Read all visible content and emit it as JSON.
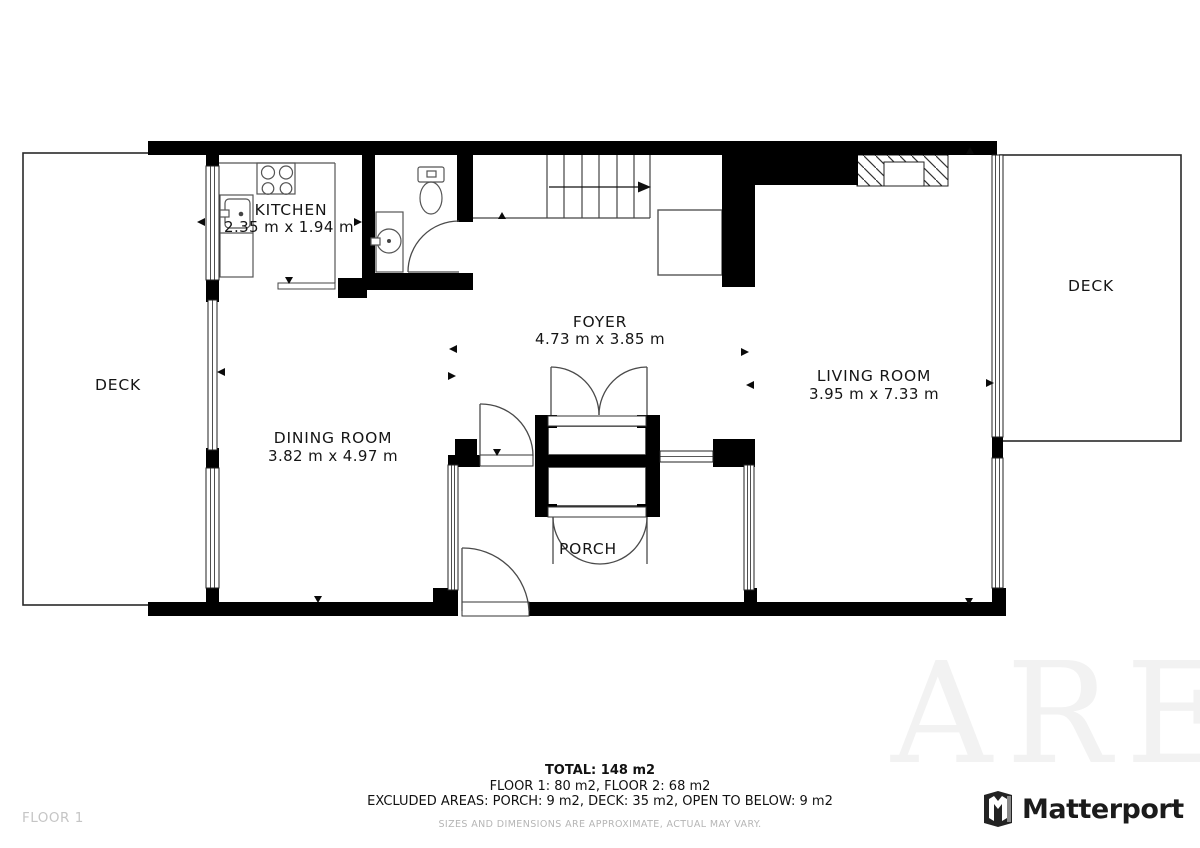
{
  "plan": {
    "floor_label": "FLOOR 1",
    "rooms": {
      "kitchen": {
        "name": "KITCHEN",
        "dims": "2.35 m x 1.94 m"
      },
      "foyer": {
        "name": "FOYER",
        "dims": "4.73 m x 3.85 m"
      },
      "dining_room": {
        "name": "DINING ROOM",
        "dims": "3.82 m x 4.97 m"
      },
      "living_room": {
        "name": "LIVING ROOM",
        "dims": "3.95 m x 7.33 m"
      },
      "porch": {
        "name": "PORCH"
      },
      "deck_left": {
        "name": "DECK"
      },
      "deck_right": {
        "name": "DECK"
      }
    }
  },
  "summary": {
    "total": "TOTAL: 148 m2",
    "floors": "FLOOR 1: 80 m2, FLOOR 2: 68 m2",
    "excluded": "EXCLUDED AREAS: PORCH: 9 m2, DECK: 35 m2, OPEN TO BELOW: 9 m2",
    "disclaimer": "SIZES AND DIMENSIONS ARE APPROXIMATE, ACTUAL MAY VARY."
  },
  "branding": {
    "name": "Matterport",
    "icon": "matterport-m-icon"
  },
  "watermark": {
    "text": "ARE"
  },
  "colors": {
    "wall": "#000000",
    "line": "#3a3a3a",
    "label": "#151515",
    "muted": "#c5c5c5",
    "disclaimer": "#b5b5b5",
    "watermark": "#f2f2f2"
  }
}
